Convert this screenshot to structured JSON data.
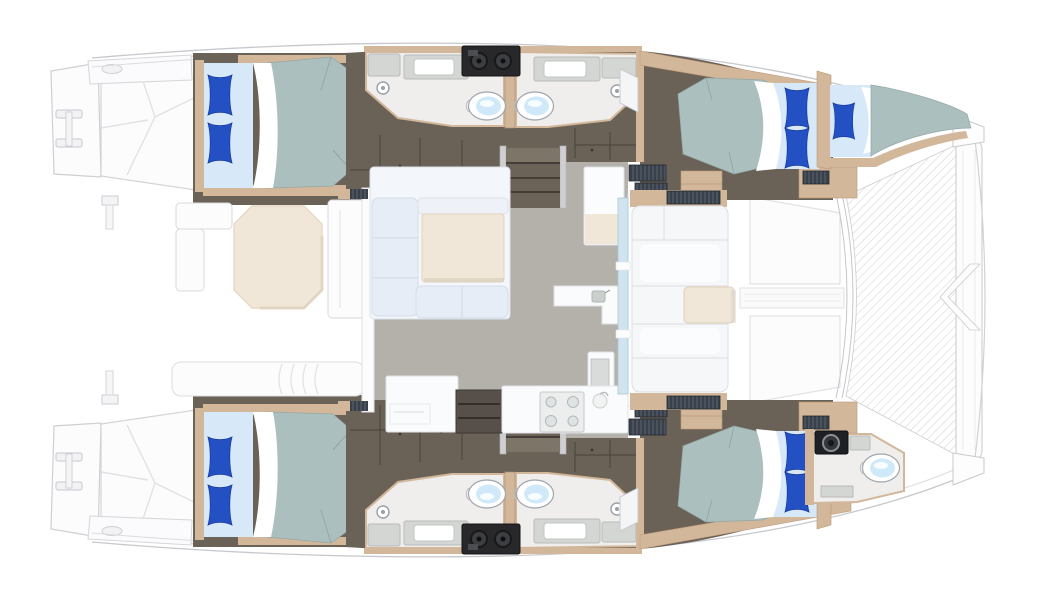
{
  "document": {
    "title": "Catamaran accommodation floor plan",
    "type": "top-down yacht layout diagram",
    "orientation": {
      "bow": "right",
      "stern": "left"
    },
    "visible_text": []
  },
  "palette": {
    "bg": "#ffffff",
    "faint-stroke": "#d4d4d9",
    "faint-fill": "#fcfcfd",
    "hull-dark": "#6b6257",
    "hull-dark-line": "#47413a",
    "tan": "#d2b79a",
    "tan-deep": "#b99877",
    "bath-floor": "#efeeec",
    "counter": "#d4d6d3",
    "floor": "#b4b1ab",
    "duvet": "#abbfbf",
    "duvet-line": "#93a7a7",
    "sheet": "#d7e9f9",
    "pillow": "#2351c4",
    "pillow-line": "#1a3d9e",
    "cream": "#f1e7d8",
    "settee": "#e6edf6",
    "equip": "#28282b",
    "glass": "#cfe4ee",
    "louver": "#3a4049",
    "toilet-seat": "#cfe9f8"
  },
  "layout": {
    "hulls": [
      {
        "id": "upper-hull",
        "cabins": [
          {
            "name": "aft-cabin",
            "bed": "double",
            "pillows": 2
          },
          {
            "name": "forward-cabin",
            "bed": "double",
            "pillows": 2
          },
          {
            "name": "forepeak-berth",
            "bed": "single",
            "pillows": 1
          }
        ],
        "bathrooms": [
          {
            "name": "aft-head",
            "fixtures": [
              "toilet",
              "sink-counter",
              "shower-head"
            ]
          },
          {
            "name": "forward-head",
            "fixtures": [
              "toilet",
              "sink-counter",
              "shower-head"
            ]
          }
        ],
        "features": [
          "companionway-stairs",
          "wardrobe-lockers",
          "equipment-unit-two-dials",
          "transom-steps",
          "swim-ladder"
        ]
      },
      {
        "id": "lower-hull",
        "cabins": [
          {
            "name": "aft-cabin",
            "bed": "double",
            "pillows": 2
          },
          {
            "name": "forward-cabin",
            "bed": "double",
            "pillows": 2
          }
        ],
        "bathrooms": [
          {
            "name": "aft-head",
            "fixtures": [
              "toilet",
              "sink-counter",
              "shower-head"
            ]
          },
          {
            "name": "forward-head",
            "fixtures": [
              "toilet",
              "sink-counter",
              "shower-head"
            ]
          },
          {
            "name": "forepeak-head",
            "fixtures": [
              "toilet",
              "washer-unit",
              "sink-counter"
            ]
          }
        ],
        "features": [
          "companionway-stairs",
          "wardrobe-lockers",
          "equipment-unit-two-dials",
          "transom-steps",
          "swim-ladder"
        ]
      }
    ],
    "bridgedeck": {
      "aft_cockpit": [
        "octagonal-table",
        "l-shaped-bench",
        "side-bench",
        "aft-lounge-bench",
        "davit-fittings"
      ],
      "salon": [
        "u-shaped-settee",
        "dining-table",
        "side-cabinet",
        "island-counter-with-sink",
        "refrigerator",
        "galley-counter",
        "open-shelf-unit",
        "cooktop-4-burner",
        "round-sink",
        "front-window-band"
      ],
      "forward_cockpit": [
        "bench-seating",
        "cockpit-table",
        "louvered-lockers"
      ],
      "foredeck": [
        "sun-pad-port",
        "walk-pad",
        "sun-pad-starboard",
        "trampoline-net",
        "forward-crossbeam",
        "bow-chevron-fitting"
      ]
    }
  },
  "counts": {
    "double_beds": 4,
    "single_berths": 1,
    "toilets": 5,
    "shower_heads": 4,
    "tables": 3,
    "stair_flights": 2
  }
}
